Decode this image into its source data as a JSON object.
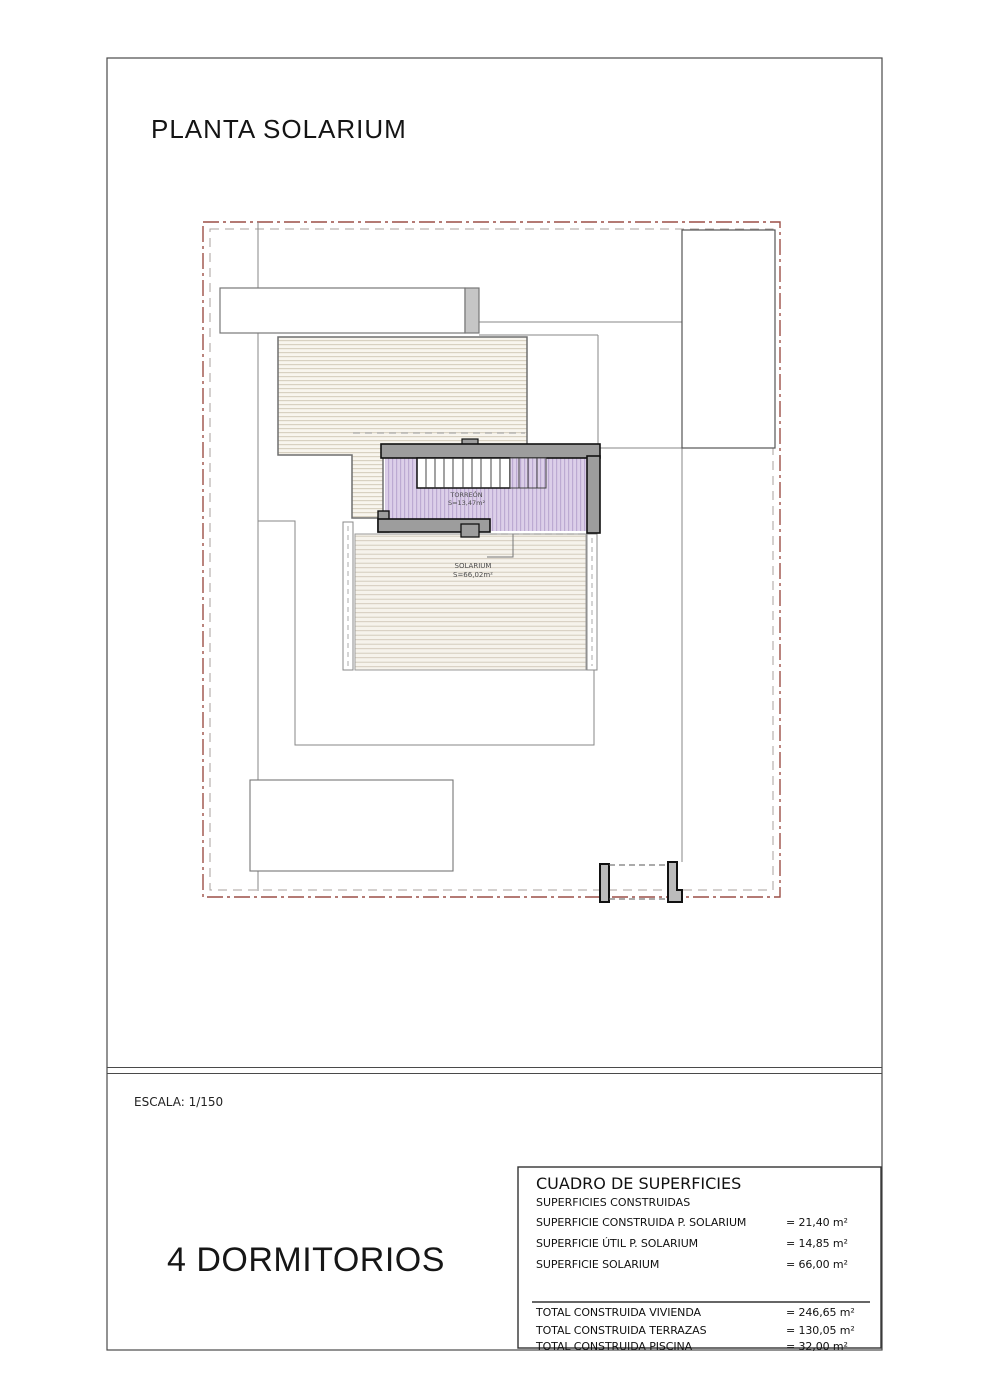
{
  "sheet": {
    "title": "PLANTA SOLARIUM",
    "scale": "ESCALA: 1/150",
    "bedrooms": "4 DORMITORIOS"
  },
  "plan": {
    "torreon": {
      "name": "TORREÓN",
      "area": "S=13,47m²"
    },
    "solarium": {
      "name": "SOLARIUM",
      "area": "S=66,02m²"
    }
  },
  "surfaces_table": {
    "title": "CUADRO DE SUPERFICIES",
    "subtitle": "SUPERFICIES CONSTRUIDAS",
    "rows": [
      {
        "label": "SUPERFICIE CONSTRUIDA P. SOLARIUM",
        "value": "= 21,40 m²"
      },
      {
        "label": "SUPERFICIE ÚTIL P. SOLARIUM",
        "value": "= 14,85 m²"
      },
      {
        "label": "SUPERFICIE SOLARIUM",
        "value": "= 66,00 m²"
      }
    ],
    "totals": [
      {
        "label": "TOTAL CONSTRUIDA VIVIENDA",
        "value": "= 246,65 m²"
      },
      {
        "label": "TOTAL CONSTRUIDA TERRAZAS",
        "value": "= 130,05 m²"
      },
      {
        "label": "TOTAL CONSTRUIDA PISCINA",
        "value": "= 32,00 m²"
      }
    ]
  },
  "colors": {
    "plot_boundary_red": "#9c4f46",
    "wall_gray": "#9d9d9d",
    "torreon_fill": "#dccfe9",
    "torreon_hatch_line": "#b19ecb",
    "deck_hatch_fill": "#f7f4ec",
    "deck_hatch_line": "#cec5b2"
  }
}
